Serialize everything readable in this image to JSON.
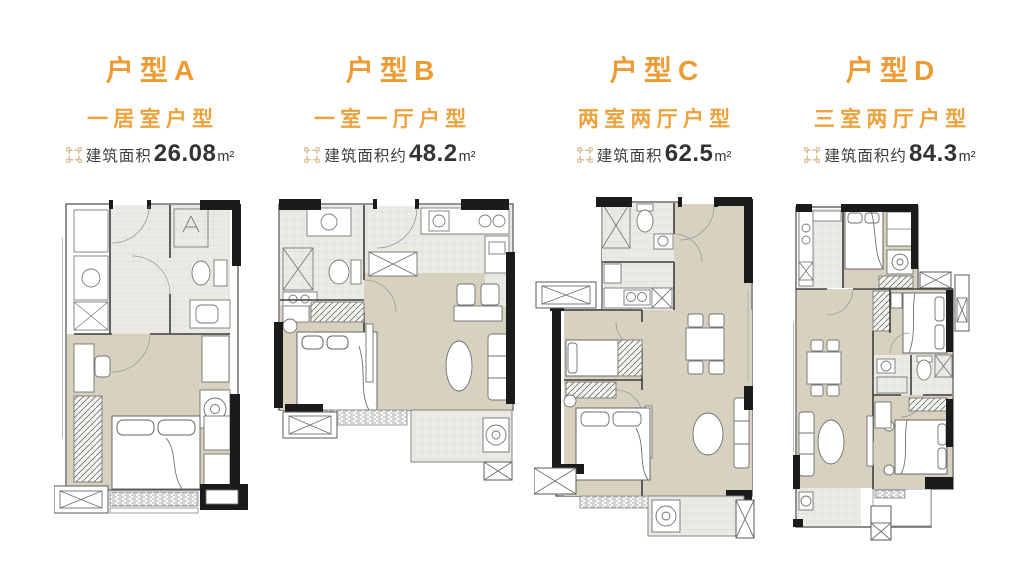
{
  "colors": {
    "accent_orange": "#ED9B33",
    "area_text": "#3E3E3E",
    "icon_tan": "#D8B88C",
    "floor_beige": "#D7D2C0",
    "wall_black": "#1B1B1B"
  },
  "units": [
    {
      "id": "A",
      "title": "户型A",
      "type_label": "一居室户型",
      "area_prefix": "建筑面积",
      "area_value": "26.08",
      "area_unit": "m²"
    },
    {
      "id": "B",
      "title": "户型B",
      "type_label": "一室一厅户型",
      "area_prefix": "建筑面积约",
      "area_value": "48.2",
      "area_unit": "m²"
    },
    {
      "id": "C",
      "title": "户型C",
      "type_label": "两室两厅户型",
      "area_prefix": "建筑面积",
      "area_value": "62.5",
      "area_unit": "m²"
    },
    {
      "id": "D",
      "title": "户型D",
      "type_label": "三室两厅户型",
      "area_prefix": "建筑面积约",
      "area_value": "84.3",
      "area_unit": "m²"
    }
  ]
}
